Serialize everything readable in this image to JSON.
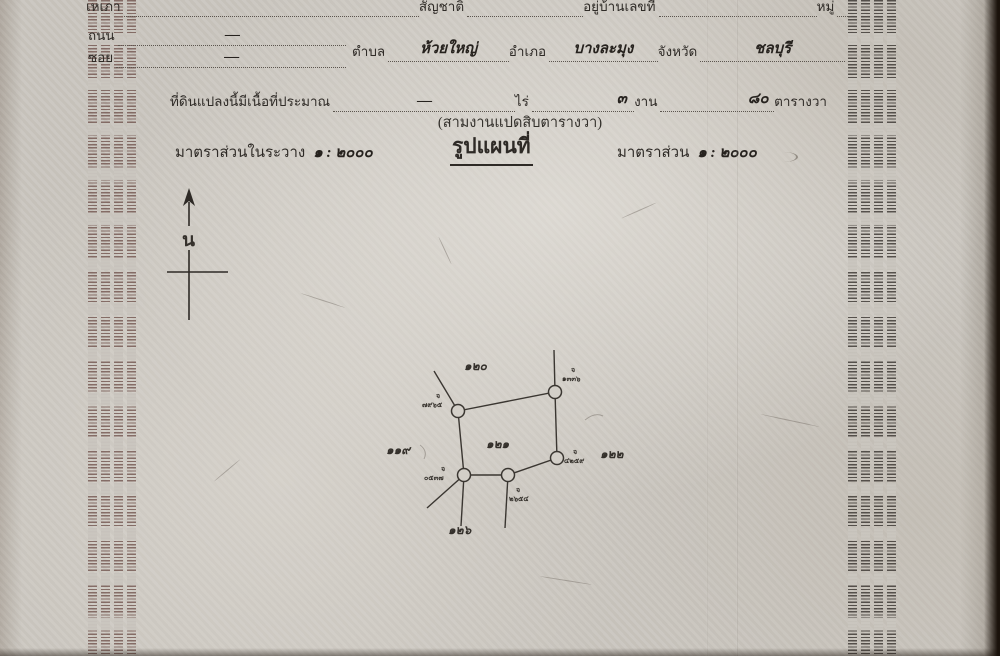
{
  "header": {
    "line1": {
      "field1": "เหเภา",
      "field2": "สัญชาติ",
      "field3": "อยู่บ้านเลขที่",
      "field4": "หมู่"
    },
    "road": {
      "label": "ถนน",
      "value": "—"
    },
    "soi": {
      "label": "ซอย",
      "value": "—"
    },
    "location": {
      "subdistrict_label": "ตำบล",
      "subdistrict_value": "ห้วยใหญ่",
      "district_label": "อำเภอ",
      "district_value": "บางละมุง",
      "province_label": "จังหวัด",
      "province_value": "ชลบุรี"
    },
    "area": {
      "prefix": "ที่ดินแปลงนี้มีเนื้อที่ประมาณ",
      "rai_value": "—",
      "rai_label": "ไร่",
      "ngan_value": "๓",
      "ngan_label": "งาน",
      "wa_value": "๘๐",
      "wa_label": "ตารางวา"
    },
    "area_words": "(สามงานแปดสิบตารางวา)",
    "scale_in_sheet_label": "มาตราส่วนในระวาง",
    "scale_in_sheet_value": "๑ : ๒๐๐๐",
    "map_title": "รูปแผนที่",
    "scale_label": "มาตราส่วน",
    "scale_value": "๑ : ๒๐๐๐"
  },
  "compass": {
    "label": "น"
  },
  "map": {
    "parcel_number": "๑๒๑",
    "adjacent_parcels": {
      "top": "๑๒๐",
      "left": "๑๑๙",
      "right": "๑๒๒",
      "bottom": "๑๒๖"
    },
    "markers": [
      {
        "prefix": "จ",
        "number": "๗๙๖๕"
      },
      {
        "prefix": "จ",
        "number": "๑๓๓๖"
      },
      {
        "prefix": "จ",
        "number": "๔๒๕๙"
      },
      {
        "prefix": "จ",
        "number": "๐๕๓๗"
      },
      {
        "prefix": "จ",
        "number": "๒๖๕๔"
      }
    ]
  },
  "colors": {
    "paper": "#cac6bf",
    "ink": "#2e2a26",
    "microtext_left": "#68483f",
    "microtext_right": "#342f2b"
  }
}
